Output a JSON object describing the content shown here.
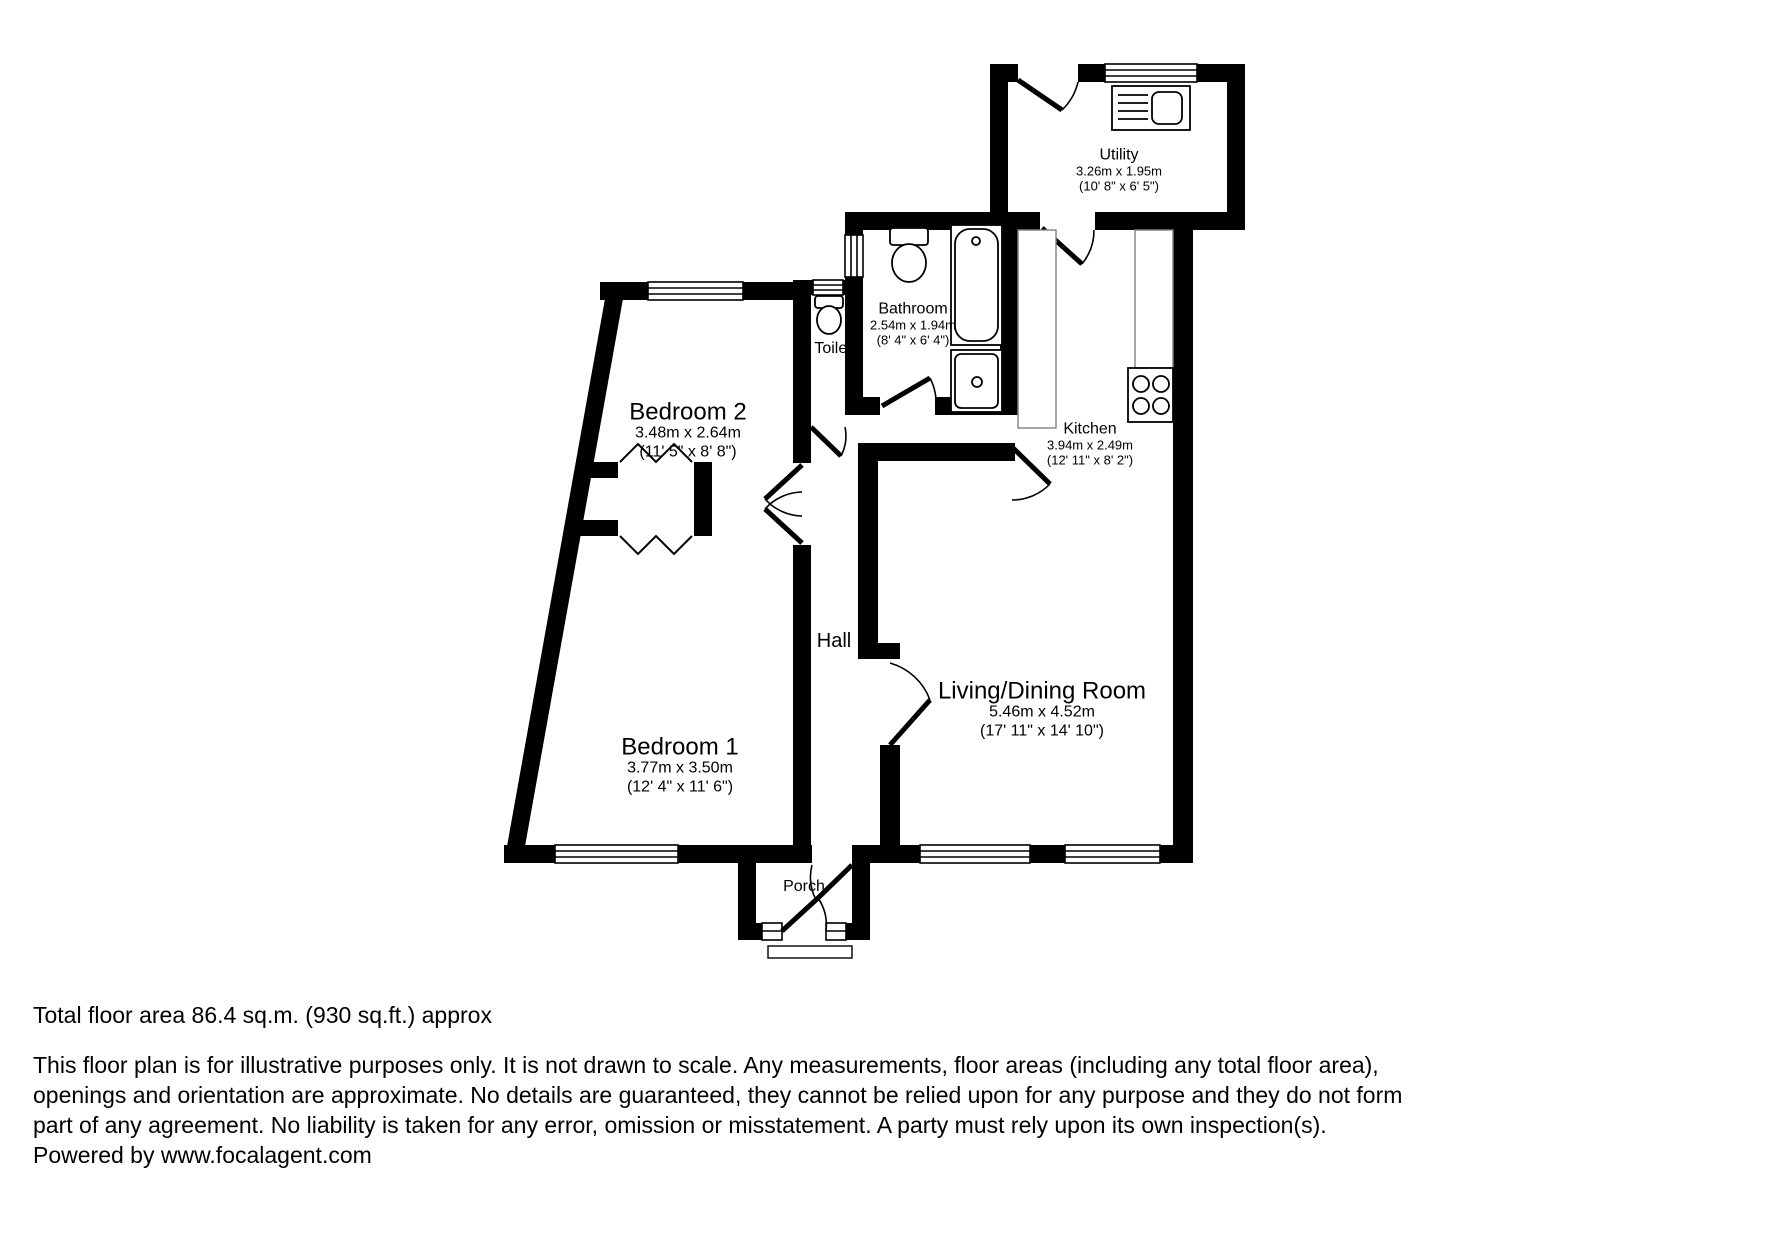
{
  "plan": {
    "rooms": [
      {
        "name": "Utility",
        "metric": "3.26m x 1.95m",
        "imperial": "(10' 8\" x 6' 5\")"
      },
      {
        "name": "Bathroom",
        "metric": "2.54m x 1.94m",
        "imperial": "(8' 4\" x 6' 4\")"
      },
      {
        "name": "Toilet"
      },
      {
        "name": "Kitchen",
        "metric": "3.94m x 2.49m",
        "imperial": "(12' 11\" x 8' 2\")"
      },
      {
        "name": "Bedroom 2",
        "metric": "3.48m x 2.64m",
        "imperial": "(11' 5\" x 8' 8\")"
      },
      {
        "name": "Bedroom 1",
        "metric": "3.77m x 3.50m",
        "imperial": "(12' 4\" x 11' 6\")"
      },
      {
        "name": "Living/Dining Room",
        "metric": "5.46m x 4.52m",
        "imperial": "(17' 11\" x 14' 10\")"
      },
      {
        "name": "Hall"
      },
      {
        "name": "Porch"
      }
    ],
    "fixtures": [
      "toilet",
      "toilet",
      "bathtub",
      "shower-tray",
      "utility-sink",
      "hob",
      "kitchen-counter"
    ],
    "colors": {
      "wall": "#000000",
      "fixture_outline": "#000000",
      "counter_outline": "#808080",
      "background": "#ffffff",
      "text": "#000000"
    }
  },
  "footer": {
    "total_area": "Total floor area 86.4 sq.m. (930 sq.ft.) approx",
    "disclaimer_lines": [
      "This floor plan is for illustrative purposes only. It is not drawn to scale. Any measurements, floor areas (including any total floor area),",
      "openings and orientation are approximate. No details are guaranteed, they cannot be relied upon for any purpose and they do not form",
      "part of any agreement. No liability is taken for any error, omission or misstatement. A party must rely upon its own inspection(s).",
      "Powered by www.focalagent.com"
    ]
  }
}
